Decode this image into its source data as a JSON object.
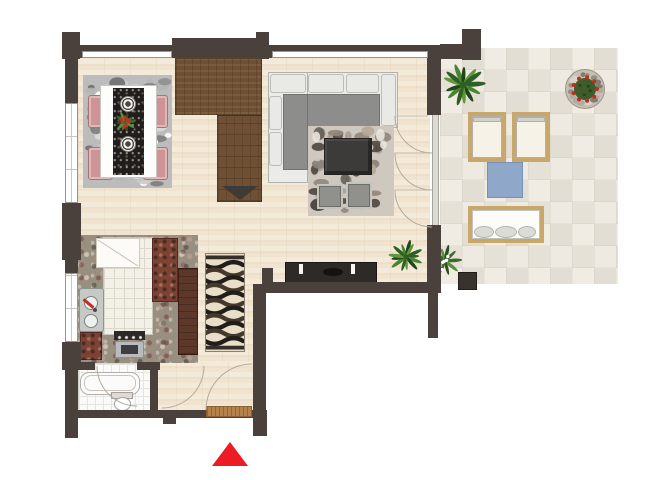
{
  "title": "apartment-floor-plan",
  "colors": {
    "wall": "#4a403c",
    "floor_wood": "#f3ead9",
    "stairs_wood": "#6f5034",
    "terrace_stone": "#e8e4db",
    "kitchen_granite": "#998f80",
    "bathroom_tile": "#fafaf8",
    "dining_rug": "#bcbcbc",
    "living_rug": "#cec8bf",
    "sofa_seat": "#8d8d8b",
    "chair_pink": "#cf9295",
    "cabinet_red_brown": "#7c4335",
    "sideboard": "#2e2a27",
    "doormat": "#b5824c",
    "lounger_wood": "#c9a76a",
    "mat_blue": "#8fa7c9",
    "accent_red": "#ed1c24"
  },
  "palettes": {
    "rug_dining": [
      "#ffffff",
      "#dcdcdc",
      "#b5b5b5",
      "#8f8f8f",
      "#6e6e6e",
      "#c9c9c9",
      "#7d7d7d"
    ],
    "rug_living": [
      "#e9e5df",
      "#cfc9c0",
      "#a89f94",
      "#8a8178",
      "#675f56",
      "#4d463e",
      "#b5a797",
      "#93867a"
    ],
    "palm": [
      "#2f5f24",
      "#4a8430",
      "#1e4719",
      "#61963d"
    ],
    "flower_green": [
      "#3c6b2c",
      "#55913a",
      "#2a5220"
    ],
    "planter_ring": [
      "#b2aa9e",
      "#978f83",
      "#d8d2c8",
      "#847c70"
    ],
    "waves": [
      "#211d1a",
      "#45382c"
    ]
  },
  "markers": {
    "entrance": "red-triangle-up",
    "stair_direction": "dark-triangle-down"
  },
  "rooms": [
    {
      "id": "dining-area",
      "items": [
        "area-rug",
        "dining-table",
        "table-runner",
        "decorated-plates",
        "plant-centerpiece",
        "chairs-x4"
      ]
    },
    {
      "id": "living-room",
      "items": [
        "corner-sofa",
        "pebble-rug",
        "coffee-table",
        "poufs-x2",
        "sideboard",
        "candlesticks",
        "potted-palm"
      ]
    },
    {
      "id": "kitchen",
      "items": [
        "tiled-island",
        "sink",
        "stove-oven",
        "cabinets"
      ]
    },
    {
      "id": "bathroom",
      "items": [
        "bathtub",
        "toilet"
      ]
    },
    {
      "id": "entrance-hall",
      "items": [
        "doormat",
        "entrance-door"
      ]
    },
    {
      "id": "staircase",
      "items": [
        "direction-arrow"
      ]
    },
    {
      "id": "terrace",
      "items": [
        "sun-loungers-x2",
        "blue-mat",
        "daybed-bench",
        "potted-palm",
        "flowering-plant",
        "round-planter",
        "planter-box"
      ]
    }
  ]
}
